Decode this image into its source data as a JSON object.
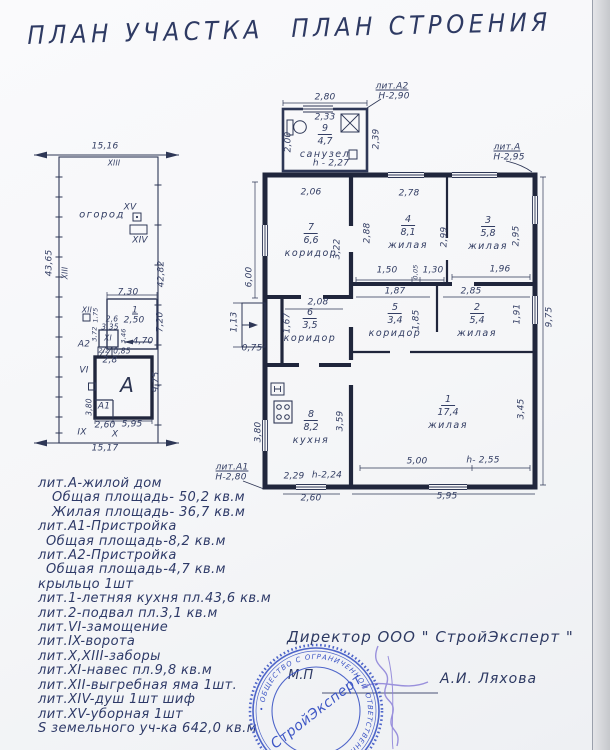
{
  "titles": {
    "site": "ПЛАН УЧАСТКА",
    "building": "ПЛАН СТРОЕНИЯ"
  },
  "site_plan": {
    "dim_top": "15,16",
    "dim_bottom": "15,17",
    "dim_left": "43,65",
    "dim_right": "42,82",
    "fence_top": "XIII",
    "fence_left": "XIII",
    "garden": "огород",
    "xv": "XV",
    "xiv": "XIV",
    "xii": "XII",
    "xi": "XI",
    "vi": "VI",
    "ix": "IX",
    "x": "X",
    "bldg_a": "А",
    "bldg_a1": "А1",
    "bldg_a2": "А2",
    "bldg_1": "1",
    "d_730": "7,30",
    "d_250": "2,50",
    "d_720": "7,20",
    "d_175": "1,75",
    "d_26": "2,6",
    "d_335": "3,35",
    "d_372": "3,72",
    "d_346": "3,46",
    "d_470": "4,70",
    "d_22": "2,2",
    "d_085": "0,85",
    "d_28": "2,8",
    "d_975": "9,75",
    "d_380": "3,80",
    "d_260": "2,60",
    "d_595": "5,95"
  },
  "building_plan": {
    "lit_a2": "лит.А2",
    "lit_a2_h": "Н-2,90",
    "lit_a": "лит.А",
    "lit_a_h": "Н-2,95",
    "lit_a1": "лит.А1",
    "lit_a1_h": "Н-2,80",
    "rooms": [
      {
        "num": "9",
        "area": "4,7",
        "name": "санузел"
      },
      {
        "num": "7",
        "area": "6,6",
        "name": "коридор"
      },
      {
        "num": "4",
        "area": "8,1",
        "name": "жилая"
      },
      {
        "num": "3",
        "area": "5,8",
        "name": "жилая"
      },
      {
        "num": "6",
        "area": "3,5",
        "name": "коридор"
      },
      {
        "num": "5",
        "area": "3,4",
        "name": "коридор"
      },
      {
        "num": "2",
        "area": "5,4",
        "name": "жилая"
      },
      {
        "num": "8",
        "area": "8,2",
        "name": "кухня"
      },
      {
        "num": "1",
        "area": "17,4",
        "name": "жилая"
      }
    ],
    "d": {
      "w280": "2,80",
      "w233": "2,33",
      "w200": "2,00",
      "w239": "2,39",
      "h227": "h - 2,27",
      "w206": "2,06",
      "w322": "3,22",
      "w288": "2,88",
      "w278": "2,78",
      "w299": "2,99",
      "w295": "2,95",
      "w600": "6,00",
      "w150": "1,50",
      "w005": "0,05",
      "w130": "1,30",
      "w196": "1,96",
      "w113": "1,13",
      "w075": "0,75",
      "w208": "2,08",
      "w167": "1,67",
      "w187": "1,87",
      "w185": "1,85",
      "w285": "2,85",
      "w191": "1,91",
      "w975": "9,75",
      "w380": "3,80",
      "w359": "3,59",
      "w229": "2,29",
      "h224": "h-2,24",
      "w260": "2,60",
      "w345": "3,45",
      "w500": "5,00",
      "h255": "h- 2,55",
      "w595": "5,95"
    }
  },
  "legend": {
    "lines": [
      "лит.А-жилой дом",
      "Общая площадь- 50,2 кв.м",
      "Жилая площадь- 36,7 кв.м",
      "лит.А1-Пристройка",
      "Общая площадь-8,2 кв.м",
      "лит.А2-Пристройка",
      "Общая площадь-4,7 кв.м",
      "крыльцо 1шт",
      "лит.1-летняя кухня пл.43,6 кв.м",
      "лит.2-подвал пл.3,1 кв.м",
      "лит.VI-замощение",
      "лит.IX-ворота",
      "лит.X,XIII-заборы",
      "лит.XI-навес пл.9,8 кв.м",
      "лит.XII-выгребная яма 1шт.",
      "лит.XIV-душ 1шт шиф",
      "лит.XV-уборная 1шт",
      "S земельного уч-ка 642,0 кв.м"
    ]
  },
  "signature": {
    "director": "Директор ООО \" СтройЭксперт \"",
    "mp": "М.П",
    "name": "А.И. Ляхова",
    "stamp_center": "СтройЭксперт",
    "stamp_ring": "• ОБЩЕСТВО С ОГРАНИЧЕННОЙ ОТВЕТСТВЕННОСТЬЮ •"
  },
  "colors": {
    "ink": "#333e66",
    "wall": "#20263c",
    "stamp_blue": "#3d56c5",
    "signature_purple": "#8a7fd8",
    "paper": "#f6f6f8"
  }
}
